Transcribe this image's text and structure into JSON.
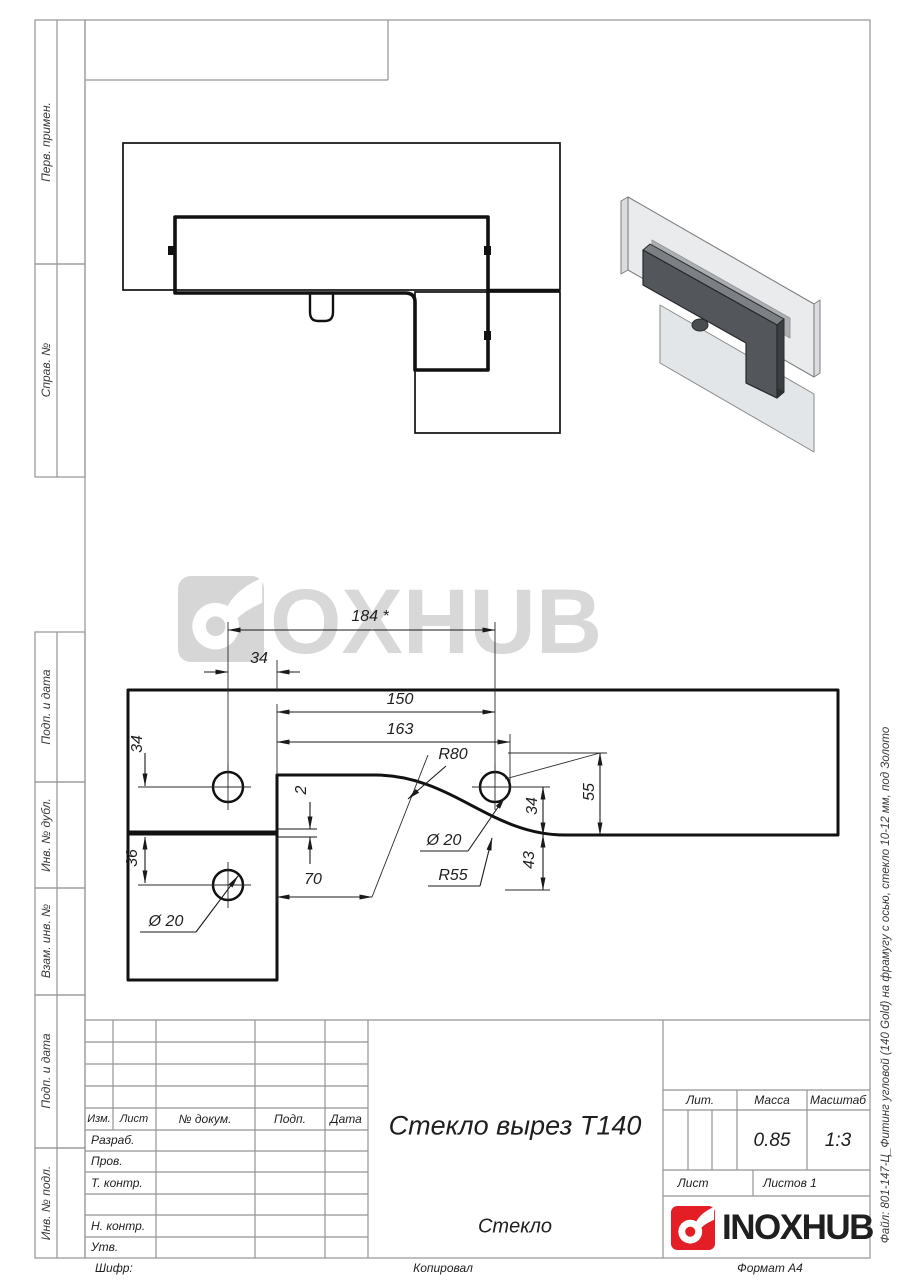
{
  "margin_labels": {
    "perv": "Перв. примен.",
    "sprav": "Справ. №",
    "podp1": "Подп. и дата",
    "inv_dubl": "Инв. № дубл.",
    "vzam": "Взам. инв. №",
    "podp2": "Подп. и дата",
    "inv_podl": "Инв. № подл."
  },
  "page_notes": {
    "code_label": "Шифр:",
    "copied_label": "Копировал",
    "format_label": "Формат А4",
    "file_note": "Файл: 801-147-Ц_Фитинг угловой (140 Gold)  на фрамугу с осью, стекло 10-12 мм, под Золото"
  },
  "watermark": {
    "brand": "INOXHUB"
  },
  "title_block": {
    "rev_headers": {
      "izm": "Изм.",
      "list": "Лист",
      "doc": "№ докум.",
      "podp": "Подп.",
      "data": "Дата"
    },
    "sig_rows": {
      "razrab": "Разраб.",
      "prov": "Пров.",
      "tkontr": "Т. контр.",
      "nkontr": "Н. контр.",
      "utv": "Утв."
    },
    "part_title": "Стекло вырез Т140",
    "lit_label": "Лит.",
    "mass_label": "Масса",
    "scale_label": "Масштаб",
    "mass_value": "0.85",
    "scale_value": "1:3",
    "sheet_label": "Лист",
    "sheets_label": "Листов 1",
    "material": "Стекло",
    "brand": "INOXHUB"
  },
  "front_view": {
    "dims": {
      "total": "184 *",
      "offset34": "34",
      "len150": "150",
      "len163": "163",
      "r80": "R80",
      "gap2": "2",
      "h55": "55",
      "h34_right": "34",
      "h43": "43",
      "len70": "70",
      "dia20_right": "Ø 20",
      "r55": "R55",
      "v34_left": "34",
      "v36": "36",
      "dia20_left": "Ø 20"
    }
  }
}
